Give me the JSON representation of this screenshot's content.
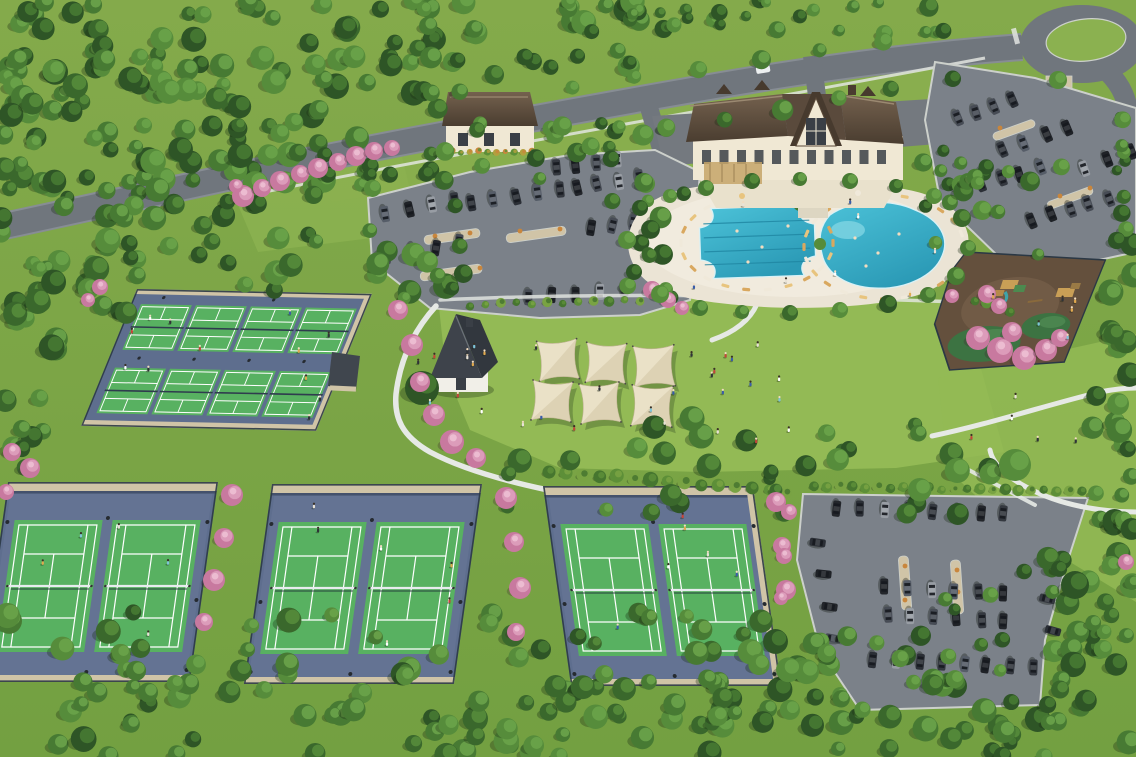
{
  "scene_type": "aerial-rendering-community-amenity-center",
  "features": {
    "pickleball_courts": 8,
    "tennis_courts": 6,
    "tennis_enclosures": 3,
    "swimming_pools": 2,
    "shade_sails": 6,
    "parking_lots": 3,
    "playground": 1,
    "clubhouse": 1,
    "roundabout": 1
  },
  "areas": [
    "forest",
    "entry-road",
    "roundabout",
    "clubhouse",
    "pool-deck",
    "lap-pool",
    "leisure-pool",
    "event-lawn",
    "shade-sails",
    "pickleball-complex",
    "tennis-courts",
    "playground",
    "parking-lots",
    "walking-paths",
    "flowering-trees"
  ],
  "colors": {
    "grass_top": "#84aa4b",
    "grass_bottom": "#73a041",
    "lawn": "#93ba55",
    "meadow": "#8bb150",
    "tree1": "#2e5526",
    "tree2": "#3a682c",
    "tree3": "#477a33",
    "tree4": "#568c3b",
    "tree5": "#6aa34a",
    "pink1": "#c8799f",
    "pink2": "#dc9cba",
    "pink3": "#edc0d4",
    "hedge1": "#46762f",
    "hedge2": "#5d8f38",
    "hedge3": "#79a343",
    "road": "#70767d",
    "curb": "#ccd0cb",
    "parking": "#7b8189",
    "sidewalk": "#e2e5df",
    "glass": "#161a1f",
    "deck": "#ebe4d5",
    "deck2": "#f4eee1",
    "water": "#3eb7cd",
    "water_deep": "#2b9ab6",
    "lane": "#1f86a2",
    "waterline": "#d8f1f6",
    "roof_light": "#74614e",
    "roof_dark": "#4a3d30",
    "ridge": "#9b8971",
    "wall_cream": "#f0e8d4",
    "timber": "#5b4a3a",
    "window": "#3a3f46",
    "patio": "#e9e1cc",
    "pergola": "#c5a469",
    "court_base": "#5e6e8e",
    "court_base2": "#73829f",
    "court_green": "#58b161",
    "court_line": "#ffffff",
    "net": "#e8ecef",
    "pb_net": "#2f3c4e",
    "fence": "#2b3845",
    "wall_tan": "#d0c4a7",
    "sail": "#eae1c7",
    "sail_shade": "#cfc3a2",
    "sail_edge": "#bdb290",
    "mulch": "#64503d",
    "mulch2": "#7b654e",
    "dome": "#3c7342",
    "path": "#e6e9e5",
    "shrub_orange": "#c9863c",
    "shrub_yellow": "#b2a03e",
    "chair1": "#d9a85f",
    "chair2": "#e8c47e",
    "chair3": "#f0e9da",
    "car_colors": [
      "#23262b",
      "#34383f",
      "#474c55",
      "#1f2227",
      "#565d68",
      "#989da4",
      "#2b2f36"
    ],
    "people_colors": [
      "#ffffff",
      "#e8e2d6",
      "#c2453a",
      "#3a5ca8",
      "#e0a94f",
      "#2f3338",
      "#7fc4d8"
    ],
    "skin": "#f2dcc0",
    "white_car": "#edf0f1"
  }
}
